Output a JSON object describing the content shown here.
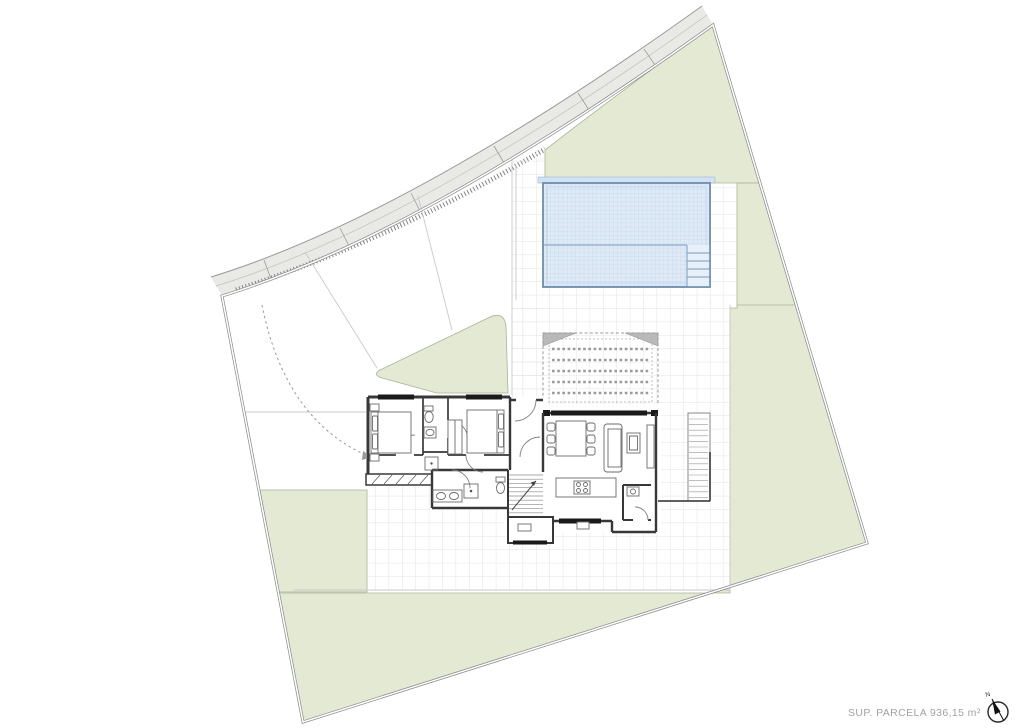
{
  "plan": {
    "area_label": "SUP. PARCELA 936,15 m²",
    "compass": {
      "north_label": "N"
    }
  },
  "colors": {
    "road_fill": "#e9e9e6",
    "road_edge": "#9a9a9a",
    "parcel_line": "#8f8f8f",
    "green": "#e4e9d3",
    "green_edge": "#a9b398",
    "grid_line": "#e3e3e3",
    "terrace_edge": "#c9c9c9",
    "pool_fill": "#dfeaf7",
    "pool_grid": "#b9cee6",
    "pool_edge": "#6f8fae",
    "pool_line": "#8fa9cc",
    "pool_coping": "#d3e1f2",
    "wall": "#383838",
    "glass": "#1a1a1a",
    "furniture": "#6b6b6b",
    "hatch": "#6f6f6f",
    "pergola_line": "#9a9a9a",
    "pergola_tri": "#b9b9b9",
    "dash": "#9a9a9a",
    "text_muted": "#a2a2a2"
  }
}
